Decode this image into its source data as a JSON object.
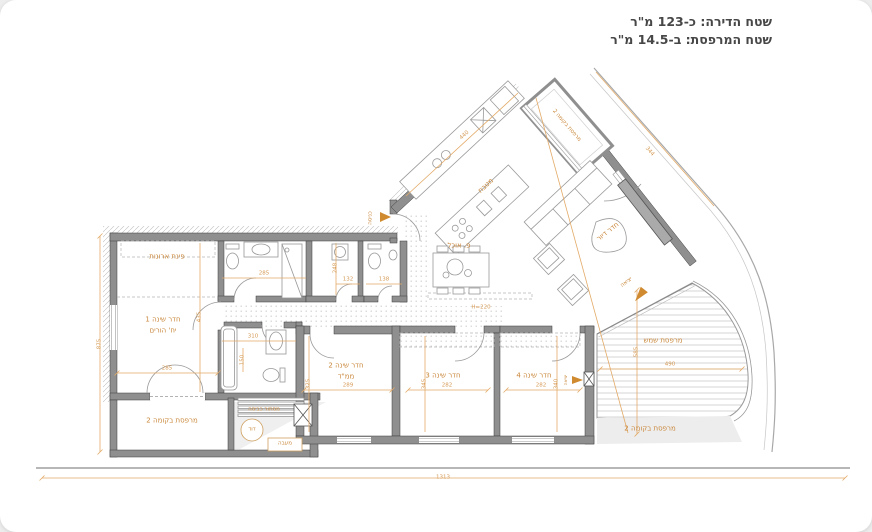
{
  "header": {
    "area_line": "שטח הדירה: כ-123 מ\"ר",
    "balcony_line": "שטח המרפסת: ב-14.5 מ\"ר"
  },
  "rooms": {
    "closet": "פינת ארונות",
    "bedroom1": "חדר שינה 1",
    "bedroom1_sub": "יח' הורים",
    "bedroom2": "חדר שינה 2",
    "bedroom2_sub": "ממ\"ד",
    "bedroom3": "חדר שינה 3",
    "bedroom4": "חדר שינה 4",
    "kitchen": "מטבח",
    "dining": "פ. אוכל",
    "living": "חדר דיור",
    "sun_terrace": "מרפסת שמש",
    "balcony_floor2_left": "מרפסת בקומה 2",
    "balcony_floor2_right": "מרפסת בקומה 2",
    "balcony_floor2_top": "מרפסת בקומה 2",
    "laundry_screen": "מסתור כביסה",
    "boiler": "דוד",
    "condenser": "מעבה"
  },
  "annotations": {
    "entrance": "כניסה",
    "exit": "יציאה",
    "exit2": "יציאה",
    "height_note": "H=220"
  },
  "dimensions": {
    "total_width": "1313",
    "left_height": "875",
    "bedroom1_width": "285",
    "bedroom1_depth": "435",
    "bath_width": "285",
    "bath_depth": "248",
    "wc1_width": "132",
    "wc2_width": "138",
    "corridor_width": "310",
    "bath2_depth": "150",
    "bedroom2_width": "289",
    "bedroom2_depth": "325",
    "bedroom3_width": "282",
    "bedroom3_depth": "345",
    "bedroom4_width": "282",
    "bedroom4_depth": "340",
    "terrace_width": "490",
    "terrace_depth": "585",
    "kitchen_length": "440",
    "balcony_edge": "344"
  },
  "colors": {
    "accent": "#c9873a",
    "dimension": "#e3aa67",
    "wall": "#8f8f8f",
    "text": "#474747"
  }
}
